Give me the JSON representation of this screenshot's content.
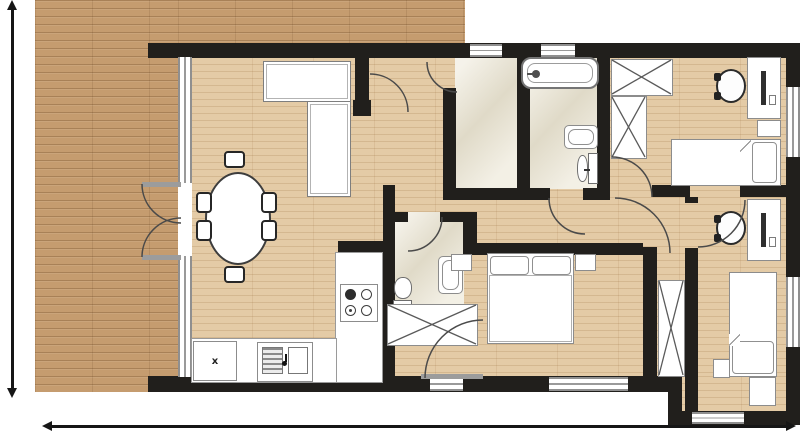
{
  "meta": {
    "type": "architectural-floor-plan",
    "canvas_w": 800,
    "canvas_h": 433
  },
  "palette": {
    "wall": "#211f1c",
    "deck_wood": "#c59c6f",
    "interior_wood": "#e4cba6",
    "tile": "#e9e3d0",
    "furniture_outline": "#8c8c8c",
    "window_line": "#8f8f8f",
    "door_arc": "#4a4a4a",
    "dimension": "#161616"
  },
  "labels": {
    "kitchen_appliance_x": "x"
  },
  "floors": [
    {
      "n": "deck-left",
      "fill": "deck",
      "x": 35,
      "y": 0,
      "w": 143,
      "h": 392
    },
    {
      "n": "deck-top",
      "fill": "deck",
      "x": 178,
      "y": 0,
      "w": 287,
      "h": 43
    },
    {
      "n": "interior-floor",
      "fill": "wood",
      "x": 191,
      "y": 57,
      "w": 596,
      "h": 320
    },
    {
      "n": "interior-floor-step",
      "fill": "wood",
      "x": 680,
      "y": 376,
      "w": 107,
      "h": 36
    },
    {
      "n": "utility-room-floor",
      "fill": "tile",
      "x": 455,
      "y": 57,
      "w": 63,
      "h": 132
    },
    {
      "n": "bathroom-floor",
      "fill": "tile",
      "x": 529,
      "y": 57,
      "w": 70,
      "h": 132
    },
    {
      "n": "wc-floor",
      "fill": "tile",
      "x": 394,
      "y": 212,
      "w": 70,
      "h": 100
    }
  ],
  "walls": [
    {
      "n": "exterior-wall-top",
      "x": 148,
      "y": 43,
      "w": 652,
      "h": 15
    },
    {
      "n": "exterior-wall-right",
      "x": 786,
      "y": 43,
      "w": 14,
      "h": 382
    },
    {
      "n": "exterior-wall-bottom-left",
      "x": 148,
      "y": 376,
      "w": 534,
      "h": 16
    },
    {
      "n": "exterior-wall-step",
      "x": 668,
      "y": 376,
      "w": 14,
      "h": 42
    },
    {
      "n": "exterior-wall-bottom-right",
      "x": 668,
      "y": 411,
      "w": 132,
      "h": 14
    },
    {
      "n": "glass-wall-segment-1",
      "x": 178,
      "y": 150,
      "w": 14,
      "h": 32
    },
    {
      "n": "glass-wall-segment-2",
      "x": 178,
      "y": 257,
      "w": 14,
      "h": 21
    },
    {
      "n": "glass-wall-segment-3",
      "x": 178,
      "y": 358,
      "w": 14,
      "h": 20
    },
    {
      "n": "living-room-wall-stub",
      "x": 355,
      "y": 43,
      "w": 14,
      "h": 62
    },
    {
      "n": "living-room-wall-cap",
      "x": 353,
      "y": 100,
      "w": 18,
      "h": 16
    },
    {
      "n": "entry-utility-wall",
      "x": 443,
      "y": 88,
      "w": 13,
      "h": 102
    },
    {
      "n": "utility-bath-divider",
      "x": 517,
      "y": 57,
      "w": 13,
      "h": 143
    },
    {
      "n": "bathroom-right-wall",
      "x": 597,
      "y": 43,
      "w": 13,
      "h": 157
    },
    {
      "n": "utility-bath-bottom-wall",
      "x": 443,
      "y": 188,
      "w": 107,
      "h": 12
    },
    {
      "n": "bathroom-bottom-wall",
      "x": 583,
      "y": 188,
      "w": 27,
      "h": 12
    },
    {
      "n": "bedroom1-bottom-wall-a",
      "x": 652,
      "y": 185,
      "w": 38,
      "h": 12
    },
    {
      "n": "bedroom1-bottom-wall-b",
      "x": 740,
      "y": 185,
      "w": 46,
      "h": 12
    },
    {
      "n": "wc-top-wall-a",
      "x": 394,
      "y": 212,
      "w": 14,
      "h": 10
    },
    {
      "n": "wc-top-wall-b",
      "x": 440,
      "y": 212,
      "w": 24,
      "h": 10
    },
    {
      "n": "wc-right-wall",
      "x": 463,
      "y": 212,
      "w": 14,
      "h": 42
    },
    {
      "n": "kitchen-wall",
      "x": 383,
      "y": 185,
      "w": 12,
      "h": 198
    },
    {
      "n": "kitchen-wall-stub",
      "x": 338,
      "y": 241,
      "w": 57,
      "h": 11
    },
    {
      "n": "master-top-wall",
      "x": 463,
      "y": 243,
      "w": 180,
      "h": 12
    },
    {
      "n": "master-right-wall",
      "x": 643,
      "y": 247,
      "w": 14,
      "h": 130
    },
    {
      "n": "bedroom2-left-wall-a",
      "x": 685,
      "y": 197,
      "w": 13,
      "h": 6
    },
    {
      "n": "bedroom2-left-wall-b",
      "x": 685,
      "y": 248,
      "w": 13,
      "h": 163
    }
  ],
  "windows": [
    {
      "n": "glass-wall-window",
      "x": 178,
      "y": 57,
      "w": 14,
      "h": 320
    },
    {
      "n": "terrace-door-opening",
      "x": 178,
      "y": 183,
      "w": 14,
      "h": 73,
      "plain": true
    },
    {
      "n": "window-top-1",
      "x": 470,
      "y": 44,
      "w": 32,
      "h": 13
    },
    {
      "n": "window-top-2",
      "x": 541,
      "y": 44,
      "w": 34,
      "h": 13
    },
    {
      "n": "window-bottom-1",
      "x": 430,
      "y": 377,
      "w": 33,
      "h": 14
    },
    {
      "n": "window-bottom-2",
      "x": 549,
      "y": 377,
      "w": 79,
      "h": 14
    },
    {
      "n": "window-bottom-3",
      "x": 692,
      "y": 412,
      "w": 52,
      "h": 12
    },
    {
      "n": "window-right-1",
      "x": 786,
      "y": 87,
      "w": 14,
      "h": 70
    },
    {
      "n": "window-right-2",
      "x": 786,
      "y": 277,
      "w": 14,
      "h": 70
    }
  ],
  "doors": [
    {
      "n": "terrace-french-door-arc-upper",
      "d": "M142,184 A39,39 0 0 0 181,223"
    },
    {
      "n": "terrace-french-door-arc-lower",
      "d": "M142,257 A39,39 0 0 1 181,218"
    },
    {
      "n": "living-room-door-arc",
      "d": "M370,74 A38,38 0 0 1 408,112"
    },
    {
      "n": "utility-door-arc",
      "d": "M427,62 A30,30 0 0 0 457,92"
    },
    {
      "n": "bathroom-door-arc",
      "d": "M549,198 A36,36 0 0 0 585,234"
    },
    {
      "n": "bedroom1-door-arc",
      "d": "M612,157 A40,40 0 0 1 652,197"
    },
    {
      "n": "hall-end-door-arc",
      "d": "M615,198 A55,55 0 0 1 670,253"
    },
    {
      "n": "bedroom2-door-arc",
      "d": "M745,200 A47,47 0 0 1 698,247"
    },
    {
      "n": "wc-door-arc",
      "d": "M442,217 A34,34 0 0 1 408,251"
    },
    {
      "n": "master-bedroom-door-arc",
      "d": "M483,320 A58,58 0 0 0 425,378"
    }
  ],
  "furniture": [
    {
      "t": "sofa",
      "n": "living-room-sofa-back",
      "x": 263,
      "y": 61,
      "w": 88,
      "h": 41
    },
    {
      "t": "sofa",
      "n": "living-room-sofa-side",
      "x": 307,
      "y": 101,
      "w": 44,
      "h": 96
    },
    {
      "t": "table",
      "n": "dining-table",
      "x": 205,
      "y": 172,
      "w": 66,
      "h": 93
    },
    {
      "t": "dchair",
      "n": "dining-chair-top",
      "x": 224,
      "y": 151,
      "w": 21,
      "h": 17
    },
    {
      "t": "dchair",
      "n": "dining-chair-bottom",
      "x": 224,
      "y": 266,
      "w": 21,
      "h": 17
    },
    {
      "t": "dchair",
      "n": "dining-chair-left-1",
      "x": 196,
      "y": 192,
      "w": 16,
      "h": 21
    },
    {
      "t": "dchair",
      "n": "dining-chair-left-2",
      "x": 196,
      "y": 220,
      "w": 16,
      "h": 21
    },
    {
      "t": "dchair",
      "n": "dining-chair-right-1",
      "x": 261,
      "y": 192,
      "w": 16,
      "h": 21
    },
    {
      "t": "dchair",
      "n": "dining-chair-right-2",
      "x": 261,
      "y": 220,
      "w": 16,
      "h": 21
    },
    {
      "t": "counter",
      "n": "kitchen-counter-right",
      "x": 335,
      "y": 252,
      "w": 48,
      "h": 131
    },
    {
      "t": "counter",
      "n": "kitchen-counter-bottom",
      "x": 191,
      "y": 338,
      "w": 146,
      "h": 45
    },
    {
      "t": "stove",
      "n": "stove",
      "x": 340,
      "y": 284,
      "w": 38,
      "h": 38
    },
    {
      "t": "cabx",
      "n": "kitchen-appliance-x",
      "x": 193,
      "y": 341,
      "w": 44,
      "h": 40
    },
    {
      "t": "sink",
      "n": "kitchen-sink",
      "x": 257,
      "y": 342,
      "w": 56,
      "h": 40
    },
    {
      "t": "toilet",
      "n": "wc-toilet",
      "o": "v",
      "x": 393,
      "y": 277,
      "w": 22,
      "h": 35
    },
    {
      "t": "basin",
      "n": "wc-washbasin",
      "x": 438,
      "y": 256,
      "w": 25,
      "h": 38
    },
    {
      "t": "tub",
      "n": "bathtub",
      "x": 521,
      "y": 57,
      "w": 78,
      "h": 32
    },
    {
      "t": "basin",
      "n": "bathroom-washbasin",
      "x": 564,
      "y": 125,
      "w": 34,
      "h": 24
    },
    {
      "t": "toilet",
      "n": "bathroom-toilet",
      "o": "h",
      "x": 577,
      "y": 153,
      "w": 21,
      "h": 33
    },
    {
      "t": "ward",
      "n": "bedroom1-wardrobe-a",
      "x": 611,
      "y": 59,
      "w": 62,
      "h": 37
    },
    {
      "t": "ward",
      "n": "bedroom1-wardrobe-b",
      "x": 611,
      "y": 96,
      "w": 36,
      "h": 63
    },
    {
      "t": "desk",
      "n": "bedroom1-desk",
      "x": 747,
      "y": 57,
      "w": 34,
      "h": 62
    },
    {
      "t": "ochair",
      "n": "bedroom1-office-chair",
      "x": 716,
      "y": 69,
      "w": 30,
      "h": 34
    },
    {
      "t": "ns",
      "n": "bedroom1-nightstand",
      "x": 757,
      "y": 120,
      "w": 24,
      "h": 17
    },
    {
      "t": "beds",
      "n": "bedroom1-bed",
      "x": 671,
      "y": 139,
      "w": 110,
      "h": 47
    },
    {
      "t": "pillow",
      "n": "bedroom1-pillow",
      "x": 752,
      "y": 142,
      "w": 25,
      "h": 41
    },
    {
      "t": "fold",
      "n": "bedroom1-blanket-fold",
      "x": 740,
      "y": 140,
      "w": 11,
      "h": 12
    },
    {
      "t": "desk",
      "n": "bedroom2-desk",
      "x": 747,
      "y": 199,
      "w": 34,
      "h": 62
    },
    {
      "t": "ochair",
      "n": "bedroom2-office-chair",
      "x": 716,
      "y": 211,
      "w": 30,
      "h": 34
    },
    {
      "t": "beds",
      "n": "bedroom2-bed",
      "x": 729,
      "y": 272,
      "w": 48,
      "h": 105
    },
    {
      "t": "pillow",
      "n": "bedroom2-pillow",
      "x": 732,
      "y": 341,
      "w": 42,
      "h": 33
    },
    {
      "t": "fold",
      "n": "bedroom2-blanket-fold",
      "x": 729,
      "y": 334,
      "w": 11,
      "h": 12
    },
    {
      "t": "ns",
      "n": "bedroom2-nightstand",
      "x": 713,
      "y": 359,
      "w": 17,
      "h": 19
    },
    {
      "t": "ns",
      "n": "bedroom2-bench",
      "x": 749,
      "y": 377,
      "w": 27,
      "h": 29
    },
    {
      "t": "ward",
      "n": "hall-closet",
      "x": 658,
      "y": 280,
      "w": 27,
      "h": 97
    },
    {
      "t": "ward",
      "n": "master-wardrobe",
      "x": 387,
      "y": 304,
      "w": 91,
      "h": 42
    },
    {
      "t": "ns",
      "n": "master-nightstand-left",
      "x": 451,
      "y": 254,
      "w": 21,
      "h": 17
    },
    {
      "t": "ns",
      "n": "master-nightstand-right",
      "x": 575,
      "y": 254,
      "w": 21,
      "h": 17
    },
    {
      "t": "bedd",
      "n": "master-bed",
      "x": 487,
      "y": 253,
      "w": 87,
      "h": 91
    },
    {
      "t": "pillow",
      "n": "master-pillow-left",
      "x": 490,
      "y": 256,
      "w": 39,
      "h": 19
    },
    {
      "t": "pillow",
      "n": "master-pillow-right",
      "x": 532,
      "y": 256,
      "w": 39,
      "h": 19
    },
    {
      "t": "leaf",
      "n": "master-door-leaf",
      "x": 421,
      "y": 374,
      "w": 62,
      "h": 5
    },
    {
      "t": "leaf",
      "n": "terrace-door-leaf-upper",
      "x": 142,
      "y": 182,
      "w": 39,
      "h": 5
    },
    {
      "t": "leaf",
      "n": "terrace-door-leaf-lower",
      "x": 142,
      "y": 255,
      "w": 39,
      "h": 5
    }
  ],
  "dimensions": [
    {
      "n": "height-dimension-line",
      "o": "v",
      "x": 12,
      "y1": 2,
      "y2": 396
    },
    {
      "n": "width-dimension-line",
      "o": "h",
      "y": 426,
      "x1": 44,
      "x2": 794
    }
  ]
}
